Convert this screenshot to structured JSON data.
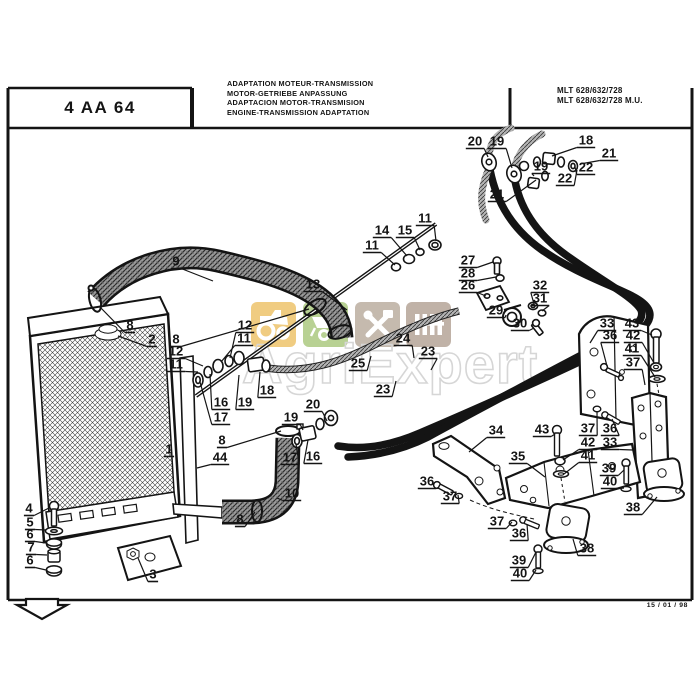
{
  "title_block": {
    "code": "4 AA 64"
  },
  "header": {
    "titles": [
      "ADAPTATION MOTEUR-TRANSMISSION",
      "MOTOR-GETRIEBE ANPASSUNG",
      "ADAPTACION MOTOR-TRANSMISION",
      "ENGINE-TRANSMISSION ADAPTATION"
    ],
    "models": [
      "MLT 628/632/728",
      "MLT 628/632/728 M.U."
    ]
  },
  "footer": {
    "date": "15 / 01 / 98"
  },
  "watermark": {
    "text": "AgriExpert",
    "tiles": [
      {
        "icon": "tractor-icon",
        "color": "#edc266"
      },
      {
        "icon": "wheelbarrow-icon",
        "color": "#a9c87c"
      },
      {
        "icon": "tools-icon",
        "color": "#b9ab9d"
      },
      {
        "icon": "grille-icon",
        "color": "#b3a294"
      }
    ]
  },
  "diagram": {
    "ink": "#141414",
    "callouts": [
      {
        "n": "9",
        "x": 176,
        "y": 261,
        "tx": 213,
        "ty": 281
      },
      {
        "n": "8",
        "x": 130,
        "y": 325,
        "tx": 99,
        "ty": 306
      },
      {
        "n": "2",
        "x": 152,
        "y": 339,
        "tx": 118,
        "ty": 336
      },
      {
        "n": "8",
        "x": 176,
        "y": 339,
        "tx": 309,
        "ty": 309
      },
      {
        "n": "12",
        "x": 245,
        "y": 325,
        "tx": 230,
        "ty": 358
      },
      {
        "n": "11",
        "x": 244,
        "y": 338,
        "tx": 221,
        "ty": 362
      },
      {
        "n": "12",
        "x": 176,
        "y": 351,
        "tx": 203,
        "ty": 366
      },
      {
        "n": "11",
        "x": 176,
        "y": 364,
        "tx": 198,
        "ty": 372
      },
      {
        "n": "16",
        "x": 221,
        "y": 402,
        "tx": 210,
        "ty": 374
      },
      {
        "n": "19",
        "x": 245,
        "y": 402,
        "tx": 239,
        "ty": 375
      },
      {
        "n": "17",
        "x": 221,
        "y": 417,
        "tx": 200,
        "ty": 382
      },
      {
        "n": "18",
        "x": 267,
        "y": 390,
        "tx": 260,
        "ty": 372
      },
      {
        "n": "1",
        "x": 169,
        "y": 449
      },
      {
        "n": "8",
        "x": 222,
        "y": 440,
        "tx": 281,
        "ty": 431
      },
      {
        "n": "44",
        "x": 220,
        "y": 457,
        "tx": 197,
        "ty": 468
      },
      {
        "n": "20",
        "x": 313,
        "y": 404,
        "tx": 327,
        "ty": 421
      },
      {
        "n": "19",
        "x": 291,
        "y": 417,
        "tx": 303,
        "ty": 430
      },
      {
        "n": "17",
        "x": 290,
        "y": 457,
        "tx": 296,
        "ty": 444
      },
      {
        "n": "16",
        "x": 313,
        "y": 456,
        "tx": 308,
        "ty": 440
      },
      {
        "n": "10",
        "x": 292,
        "y": 493,
        "tx": 277,
        "ty": 498
      },
      {
        "n": "8",
        "x": 240,
        "y": 519,
        "tx": 255,
        "ty": 512
      },
      {
        "n": "3",
        "x": 153,
        "y": 574,
        "tx": 138,
        "ty": 558
      },
      {
        "n": "4",
        "x": 29,
        "y": 508,
        "tx": 49,
        "ty": 508
      },
      {
        "n": "5",
        "x": 30,
        "y": 522,
        "tx": 46,
        "ty": 530
      },
      {
        "n": "6",
        "x": 30,
        "y": 534,
        "tx": 46,
        "ty": 543
      },
      {
        "n": "7",
        "x": 31,
        "y": 547,
        "tx": 47,
        "ty": 555
      },
      {
        "n": "6",
        "x": 30,
        "y": 560,
        "tx": 46,
        "ty": 570
      },
      {
        "n": "13",
        "x": 313,
        "y": 284,
        "tx": 347,
        "ty": 310
      },
      {
        "n": "11",
        "x": 425,
        "y": 218,
        "tx": 436,
        "ty": 241
      },
      {
        "n": "14",
        "x": 382,
        "y": 230,
        "tx": 407,
        "ty": 256
      },
      {
        "n": "15",
        "x": 405,
        "y": 230,
        "tx": 420,
        "ty": 250
      },
      {
        "n": "11",
        "x": 372,
        "y": 245,
        "tx": 395,
        "ty": 265
      },
      {
        "n": "27",
        "x": 468,
        "y": 260,
        "tx": 493,
        "ty": 262
      },
      {
        "n": "28",
        "x": 468,
        "y": 273,
        "tx": 496,
        "ty": 277
      },
      {
        "n": "26",
        "x": 468,
        "y": 285,
        "tx": 486,
        "ty": 296
      },
      {
        "n": "32",
        "x": 540,
        "y": 285,
        "tx": 534,
        "ty": 304
      },
      {
        "n": "31",
        "x": 540,
        "y": 298,
        "tx": 542,
        "ty": 311
      },
      {
        "n": "29",
        "x": 496,
        "y": 310,
        "tx": 506,
        "ty": 315
      },
      {
        "n": "30",
        "x": 520,
        "y": 323,
        "tx": 534,
        "ty": 328
      },
      {
        "n": "24",
        "x": 403,
        "y": 338,
        "tx": 414,
        "ty": 358
      },
      {
        "n": "23",
        "x": 428,
        "y": 351,
        "tx": 431,
        "ty": 370
      },
      {
        "n": "25",
        "x": 358,
        "y": 363,
        "tx": 371,
        "ty": 356
      },
      {
        "n": "23",
        "x": 383,
        "y": 389,
        "tx": 396,
        "ty": 381
      },
      {
        "n": "20",
        "x": 475,
        "y": 141,
        "tx": 488,
        "ty": 157
      },
      {
        "n": "19",
        "x": 497,
        "y": 141,
        "tx": 512,
        "ty": 168
      },
      {
        "n": "18",
        "x": 586,
        "y": 140,
        "tx": 552,
        "ty": 156
      },
      {
        "n": "21",
        "x": 609,
        "y": 153,
        "tx": 580,
        "ty": 164
      },
      {
        "n": "19",
        "x": 541,
        "y": 166,
        "tx": 534,
        "ty": 176
      },
      {
        "n": "22",
        "x": 586,
        "y": 167,
        "tx": 575,
        "ty": 167
      },
      {
        "n": "22",
        "x": 565,
        "y": 178,
        "tx": 577,
        "ty": 170
      },
      {
        "n": "21",
        "x": 497,
        "y": 194,
        "tx": 536,
        "ty": 180
      },
      {
        "n": "33",
        "x": 607,
        "y": 323,
        "tx": 590,
        "ty": 343
      },
      {
        "n": "43",
        "x": 632,
        "y": 323,
        "tx": 652,
        "ty": 335
      },
      {
        "n": "36",
        "x": 610,
        "y": 335,
        "tx": 607,
        "ty": 366
      },
      {
        "n": "42",
        "x": 633,
        "y": 335,
        "tx": 654,
        "ty": 363
      },
      {
        "n": "41",
        "x": 632,
        "y": 348,
        "tx": 655,
        "ty": 377
      },
      {
        "n": "37",
        "x": 633,
        "y": 362,
        "tx": 645,
        "ty": 385
      },
      {
        "n": "37",
        "x": 588,
        "y": 428,
        "tx": 597,
        "ty": 411
      },
      {
        "n": "36",
        "x": 610,
        "y": 428,
        "tx": 612,
        "ty": 419
      },
      {
        "n": "42",
        "x": 588,
        "y": 442,
        "tx": 563,
        "ty": 460
      },
      {
        "n": "33",
        "x": 610,
        "y": 442,
        "tx": 633,
        "ty": 450
      },
      {
        "n": "41",
        "x": 588,
        "y": 455,
        "tx": 564,
        "ty": 474
      },
      {
        "n": "39",
        "x": 609,
        "y": 468,
        "tx": 624,
        "ty": 470
      },
      {
        "n": "40",
        "x": 610,
        "y": 481,
        "tx": 624,
        "ty": 488
      },
      {
        "n": "43",
        "x": 542,
        "y": 429,
        "tx": 555,
        "ty": 434
      },
      {
        "n": "38",
        "x": 633,
        "y": 507,
        "tx": 657,
        "ty": 497
      },
      {
        "n": "34",
        "x": 496,
        "y": 430,
        "tx": 469,
        "ty": 452
      },
      {
        "n": "35",
        "x": 518,
        "y": 456,
        "tx": 545,
        "ty": 477
      },
      {
        "n": "36",
        "x": 427,
        "y": 481,
        "tx": 439,
        "ty": 487
      },
      {
        "n": "37",
        "x": 450,
        "y": 496,
        "tx": 458,
        "ty": 495
      },
      {
        "n": "37",
        "x": 497,
        "y": 521,
        "tx": 512,
        "ty": 522
      },
      {
        "n": "36",
        "x": 519,
        "y": 533,
        "tx": 527,
        "ty": 524
      },
      {
        "n": "38",
        "x": 587,
        "y": 548,
        "tx": 573,
        "ty": 539
      },
      {
        "n": "39",
        "x": 519,
        "y": 560,
        "tx": 536,
        "ty": 552
      },
      {
        "n": "40",
        "x": 520,
        "y": 573,
        "tx": 536,
        "ty": 570
      }
    ]
  }
}
